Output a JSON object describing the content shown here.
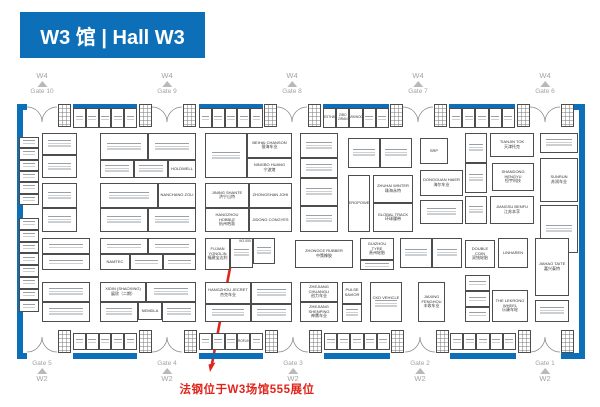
{
  "header": {
    "title": "W3 馆 | Hall W3"
  },
  "colors": {
    "blue": "#0d6fb8",
    "red": "#e0251c",
    "gray_label": "#a3a3a3"
  },
  "annotation": {
    "text": "法钢位于W3场馆555展位"
  },
  "exits": {
    "top": [
      {
        "road": "W4",
        "gate": "Gate 10",
        "x": 42
      },
      {
        "road": "W4",
        "gate": "Gate 9",
        "x": 167
      },
      {
        "road": "W4",
        "gate": "Gate 8",
        "x": 292
      },
      {
        "road": "W4",
        "gate": "Gate 7",
        "x": 418
      },
      {
        "road": "W4",
        "gate": "Gate 6",
        "x": 545
      }
    ],
    "bottom": [
      {
        "road": "W2",
        "gate": "Gate 5",
        "x": 42
      },
      {
        "road": "W2",
        "gate": "Gate 4",
        "x": 167
      },
      {
        "road": "W2",
        "gate": "Gate 3",
        "x": 293
      },
      {
        "road": "W2",
        "gate": "Gate 2",
        "x": 420
      },
      {
        "road": "W2",
        "gate": "Gate 1",
        "x": 545
      }
    ]
  },
  "floorplan": {
    "walls": {
      "top": {
        "y": 104,
        "h": 6,
        "segments": [
          [
            17,
            10
          ],
          [
            73,
            64
          ],
          [
            199,
            64
          ],
          [
            323,
            66
          ],
          [
            449,
            66
          ],
          [
            561,
            24
          ]
        ]
      },
      "bottom": {
        "y": 353,
        "h": 6,
        "segments": [
          [
            17,
            10
          ],
          [
            73,
            64
          ],
          [
            199,
            64
          ],
          [
            324,
            66
          ],
          [
            450,
            66
          ],
          [
            561,
            24
          ]
        ]
      },
      "left": {
        "x": 17,
        "y": 104,
        "w": 6,
        "h": 255
      },
      "right": {
        "x": 579,
        "y": 104,
        "w": 6,
        "h": 255
      }
    },
    "gates_top_x": [
      42,
      167,
      292,
      418,
      545
    ],
    "gates_bottom_x": [
      42,
      167,
      293,
      420,
      545
    ],
    "gridboxes": [
      [
        58,
        104
      ],
      [
        139,
        104
      ],
      [
        183,
        104
      ],
      [
        264,
        104
      ],
      [
        308,
        104
      ],
      [
        390,
        104
      ],
      [
        434,
        104
      ],
      [
        517,
        104
      ],
      [
        561,
        104
      ],
      [
        58,
        330
      ],
      [
        139,
        330
      ],
      [
        184,
        330
      ],
      [
        265,
        330
      ],
      [
        309,
        330
      ],
      [
        391,
        330
      ],
      [
        436,
        330
      ],
      [
        518,
        330
      ],
      [
        561,
        330
      ]
    ],
    "strips_h": [
      {
        "x": 73,
        "y": 108,
        "w": 64,
        "h": 20,
        "cells": 5
      },
      {
        "x": 199,
        "y": 108,
        "w": 64,
        "h": 20,
        "cells": 5
      },
      {
        "x": 323,
        "y": 108,
        "w": 66,
        "h": 20,
        "cells": 5,
        "labels": {
          "0": "HESTHAW",
          "1": "ZIBO ZIRAN",
          "2": "PARKWOOD"
        }
      },
      {
        "x": 449,
        "y": 108,
        "w": 66,
        "h": 20,
        "cells": 5
      },
      {
        "x": 73,
        "y": 333,
        "w": 64,
        "h": 17,
        "cells": 5
      },
      {
        "x": 199,
        "y": 333,
        "w": 64,
        "h": 17,
        "cells": 5,
        "labels": {
          "3": "PROFLINE"
        }
      },
      {
        "x": 324,
        "y": 333,
        "w": 66,
        "h": 17,
        "cells": 5
      },
      {
        "x": 450,
        "y": 333,
        "w": 66,
        "h": 17,
        "cells": 5
      }
    ],
    "strips_v": [
      {
        "x": 19,
        "y": 137,
        "w": 20,
        "h": 68,
        "cells": 6
      },
      {
        "x": 19,
        "y": 218,
        "w": 20,
        "h": 94,
        "cells": 8
      }
    ],
    "booths": [
      {
        "x": 42,
        "y": 133,
        "w": 35,
        "h": 22,
        "scr": 1
      },
      {
        "x": 42,
        "y": 155,
        "w": 35,
        "h": 23,
        "scr": 1
      },
      {
        "x": 42,
        "y": 183,
        "w": 35,
        "h": 25,
        "scr": 1
      },
      {
        "x": 42,
        "y": 208,
        "w": 35,
        "h": 24,
        "scr": 1
      },
      {
        "x": 100,
        "y": 133,
        "w": 48,
        "h": 27,
        "scr": 1
      },
      {
        "x": 148,
        "y": 133,
        "w": 48,
        "h": 27,
        "scr": 1
      },
      {
        "x": 100,
        "y": 160,
        "w": 34,
        "h": 18,
        "scr": 1
      },
      {
        "x": 134,
        "y": 160,
        "w": 34,
        "h": 18,
        "scr": 1
      },
      {
        "x": 168,
        "y": 160,
        "w": 28,
        "h": 18,
        "name": "HOLDWELL"
      },
      {
        "x": 100,
        "y": 183,
        "w": 58,
        "h": 25,
        "scr": 1
      },
      {
        "x": 158,
        "y": 183,
        "w": 38,
        "h": 25,
        "name": "NANCHANG ZOLI"
      },
      {
        "x": 100,
        "y": 208,
        "w": 48,
        "h": 24,
        "scr": 1
      },
      {
        "x": 148,
        "y": 208,
        "w": 48,
        "h": 24,
        "scr": 1
      },
      {
        "x": 205,
        "y": 133,
        "w": 42,
        "h": 45,
        "scr": 1
      },
      {
        "x": 247,
        "y": 133,
        "w": 45,
        "h": 25,
        "name": "BEIHAI CHANSON",
        "cn": "银海车业"
      },
      {
        "x": 247,
        "y": 158,
        "w": 45,
        "h": 20,
        "name": "NINGBO HUANG",
        "cn": "宁波煌"
      },
      {
        "x": 205,
        "y": 183,
        "w": 44,
        "h": 25,
        "name": "JINING SHANTE",
        "cn": "济宁山特"
      },
      {
        "x": 249,
        "y": 183,
        "w": 43,
        "h": 25,
        "name": "ZHONGSHAN JOHI"
      },
      {
        "x": 205,
        "y": 208,
        "w": 44,
        "h": 24,
        "name": "HANGZHOU HOBBLE",
        "cn": "杭州哈勃"
      },
      {
        "x": 249,
        "y": 208,
        "w": 43,
        "h": 24,
        "name": "JIDONG CONGYES"
      },
      {
        "x": 300,
        "y": 133,
        "w": 38,
        "h": 25,
        "scr": 1
      },
      {
        "x": 300,
        "y": 158,
        "w": 38,
        "h": 20,
        "scr": 1
      },
      {
        "x": 300,
        "y": 178,
        "w": 38,
        "h": 28,
        "scr": 1
      },
      {
        "x": 300,
        "y": 206,
        "w": 38,
        "h": 26,
        "scr": 1
      },
      {
        "x": 348,
        "y": 138,
        "w": 32,
        "h": 30,
        "scr": 1
      },
      {
        "x": 380,
        "y": 138,
        "w": 32,
        "h": 30,
        "scr": 1
      },
      {
        "x": 348,
        "y": 175,
        "w": 22,
        "h": 57,
        "name": "HEROPOWER"
      },
      {
        "x": 373,
        "y": 175,
        "w": 40,
        "h": 28,
        "name": "ZHUHAI WINTER",
        "cn": "珠海永特"
      },
      {
        "x": 373,
        "y": 203,
        "w": 40,
        "h": 29,
        "name": "GLOBAL TRACK",
        "cn": "环球履带"
      },
      {
        "x": 420,
        "y": 138,
        "w": 28,
        "h": 26,
        "name": "SRP"
      },
      {
        "x": 420,
        "y": 170,
        "w": 43,
        "h": 26,
        "name": "DONGGUAN HAIER",
        "cn": "海尔车业"
      },
      {
        "x": 420,
        "y": 200,
        "w": 43,
        "h": 24,
        "scr": 1
      },
      {
        "x": 465,
        "y": 133,
        "w": 22,
        "h": 30,
        "scr": 1
      },
      {
        "x": 465,
        "y": 163,
        "w": 22,
        "h": 30,
        "scr": 1
      },
      {
        "x": 465,
        "y": 196,
        "w": 22,
        "h": 28,
        "scr": 1
      },
      {
        "x": 490,
        "y": 133,
        "w": 44,
        "h": 24,
        "name": "TIANJIN TOK",
        "cn": "天津托克"
      },
      {
        "x": 492,
        "y": 163,
        "w": 42,
        "h": 28,
        "name": "SHANDONG HENGYU",
        "cn": "恒宇科技"
      },
      {
        "x": 490,
        "y": 196,
        "w": 44,
        "h": 28,
        "name": "JIANGSU BENFU",
        "cn": "江苏本孚"
      },
      {
        "x": 540,
        "y": 133,
        "w": 38,
        "h": 20,
        "scr": 1
      },
      {
        "x": 540,
        "y": 158,
        "w": 38,
        "h": 44,
        "name": "SUNRUN",
        "cn": "苏润车业"
      },
      {
        "x": 540,
        "y": 205,
        "w": 38,
        "h": 48,
        "scr": 1
      },
      {
        "x": 42,
        "y": 238,
        "w": 48,
        "h": 16,
        "scr": 1
      },
      {
        "x": 42,
        "y": 254,
        "w": 48,
        "h": 16,
        "scr": 1
      },
      {
        "x": 100,
        "y": 238,
        "w": 48,
        "h": 16,
        "scr": 1
      },
      {
        "x": 148,
        "y": 238,
        "w": 48,
        "h": 16,
        "scr": 1
      },
      {
        "x": 100,
        "y": 254,
        "w": 30,
        "h": 16,
        "name": "NAMTEC"
      },
      {
        "x": 130,
        "y": 254,
        "w": 33,
        "h": 16,
        "scr": 1
      },
      {
        "x": 163,
        "y": 254,
        "w": 33,
        "h": 16,
        "scr": 1
      },
      {
        "x": 205,
        "y": 238,
        "w": 25,
        "h": 32,
        "name": "FUJIAN YONGLIN",
        "cn": "福建宝达利"
      },
      {
        "x": 230,
        "y": 238,
        "w": 23,
        "h": 30,
        "num": "W3.555",
        "scr": 1
      },
      {
        "x": 253,
        "y": 238,
        "w": 22,
        "h": 26,
        "scr": 1
      },
      {
        "x": 295,
        "y": 240,
        "w": 58,
        "h": 28,
        "name": "ZHONGCE RUBBER",
        "cn": "中策橡胶"
      },
      {
        "x": 360,
        "y": 238,
        "w": 34,
        "h": 22,
        "name": "GUIZHOU TYRE",
        "cn": "贵州轮胎"
      },
      {
        "x": 360,
        "y": 260,
        "w": 34,
        "h": 10,
        "scr": 1
      },
      {
        "x": 400,
        "y": 238,
        "w": 32,
        "h": 30,
        "scr": 1
      },
      {
        "x": 432,
        "y": 238,
        "w": 30,
        "h": 30,
        "scr": 1
      },
      {
        "x": 465,
        "y": 240,
        "w": 30,
        "h": 28,
        "name": "DOUBLE COIN",
        "cn": "双钱轮胎"
      },
      {
        "x": 498,
        "y": 238,
        "w": 30,
        "h": 30,
        "name": "LINHAREN"
      },
      {
        "x": 535,
        "y": 238,
        "w": 34,
        "h": 58,
        "name": "JIAHAO TAITE",
        "cn": "嘉兴泰特"
      },
      {
        "x": 42,
        "y": 282,
        "w": 48,
        "h": 20,
        "scr": 1
      },
      {
        "x": 42,
        "y": 302,
        "w": 48,
        "h": 20,
        "scr": 1
      },
      {
        "x": 100,
        "y": 282,
        "w": 46,
        "h": 20,
        "name": "XIDIN (SHAOXING)",
        "cn": "展欣（二期）"
      },
      {
        "x": 146,
        "y": 282,
        "w": 50,
        "h": 20,
        "scr": 1
      },
      {
        "x": 100,
        "y": 302,
        "w": 38,
        "h": 20,
        "scr": 1
      },
      {
        "x": 138,
        "y": 302,
        "w": 24,
        "h": 18,
        "name": "NEMDLA"
      },
      {
        "x": 162,
        "y": 302,
        "w": 34,
        "h": 20,
        "scr": 1
      },
      {
        "x": 205,
        "y": 282,
        "w": 46,
        "h": 22,
        "name": "HANGZHOU JECRET",
        "cn": "杰克车业"
      },
      {
        "x": 251,
        "y": 282,
        "w": 41,
        "h": 22,
        "scr": 1
      },
      {
        "x": 205,
        "y": 304,
        "w": 46,
        "h": 18,
        "scr": 1
      },
      {
        "x": 251,
        "y": 304,
        "w": 41,
        "h": 18,
        "scr": 1
      },
      {
        "x": 300,
        "y": 282,
        "w": 38,
        "h": 20,
        "name": "ZHEJIANG CHUANGLI",
        "cn": "创力车业"
      },
      {
        "x": 300,
        "y": 302,
        "w": 38,
        "h": 20,
        "name": "ZHEJIANG SHENPING",
        "cn": "神鹰车业"
      },
      {
        "x": 342,
        "y": 282,
        "w": 20,
        "h": 22,
        "name": "PULSE SAVIOR"
      },
      {
        "x": 342,
        "y": 304,
        "w": 20,
        "h": 18,
        "scr": 1
      },
      {
        "x": 370,
        "y": 282,
        "w": 32,
        "h": 40,
        "name": "CKD VEHICLE",
        "scr": 1
      },
      {
        "x": 418,
        "y": 282,
        "w": 27,
        "h": 40,
        "name": "JIAXING FENGHOU",
        "cn": "丰收车业"
      },
      {
        "x": 465,
        "y": 275,
        "w": 25,
        "h": 16,
        "scr": 1
      },
      {
        "x": 465,
        "y": 291,
        "w": 25,
        "h": 16,
        "scr": 1
      },
      {
        "x": 465,
        "y": 307,
        "w": 25,
        "h": 15,
        "scr": 1
      },
      {
        "x": 492,
        "y": 290,
        "w": 36,
        "h": 32,
        "name": "THE LEKRONG WHEEL",
        "cn": "乐康车轮"
      },
      {
        "x": 535,
        "y": 300,
        "w": 34,
        "h": 22,
        "scr": 1
      }
    ],
    "arrow": {
      "x1": 233,
      "y1": 252,
      "x2": 212,
      "y2": 364,
      "tip": [
        210,
        372
      ]
    }
  }
}
